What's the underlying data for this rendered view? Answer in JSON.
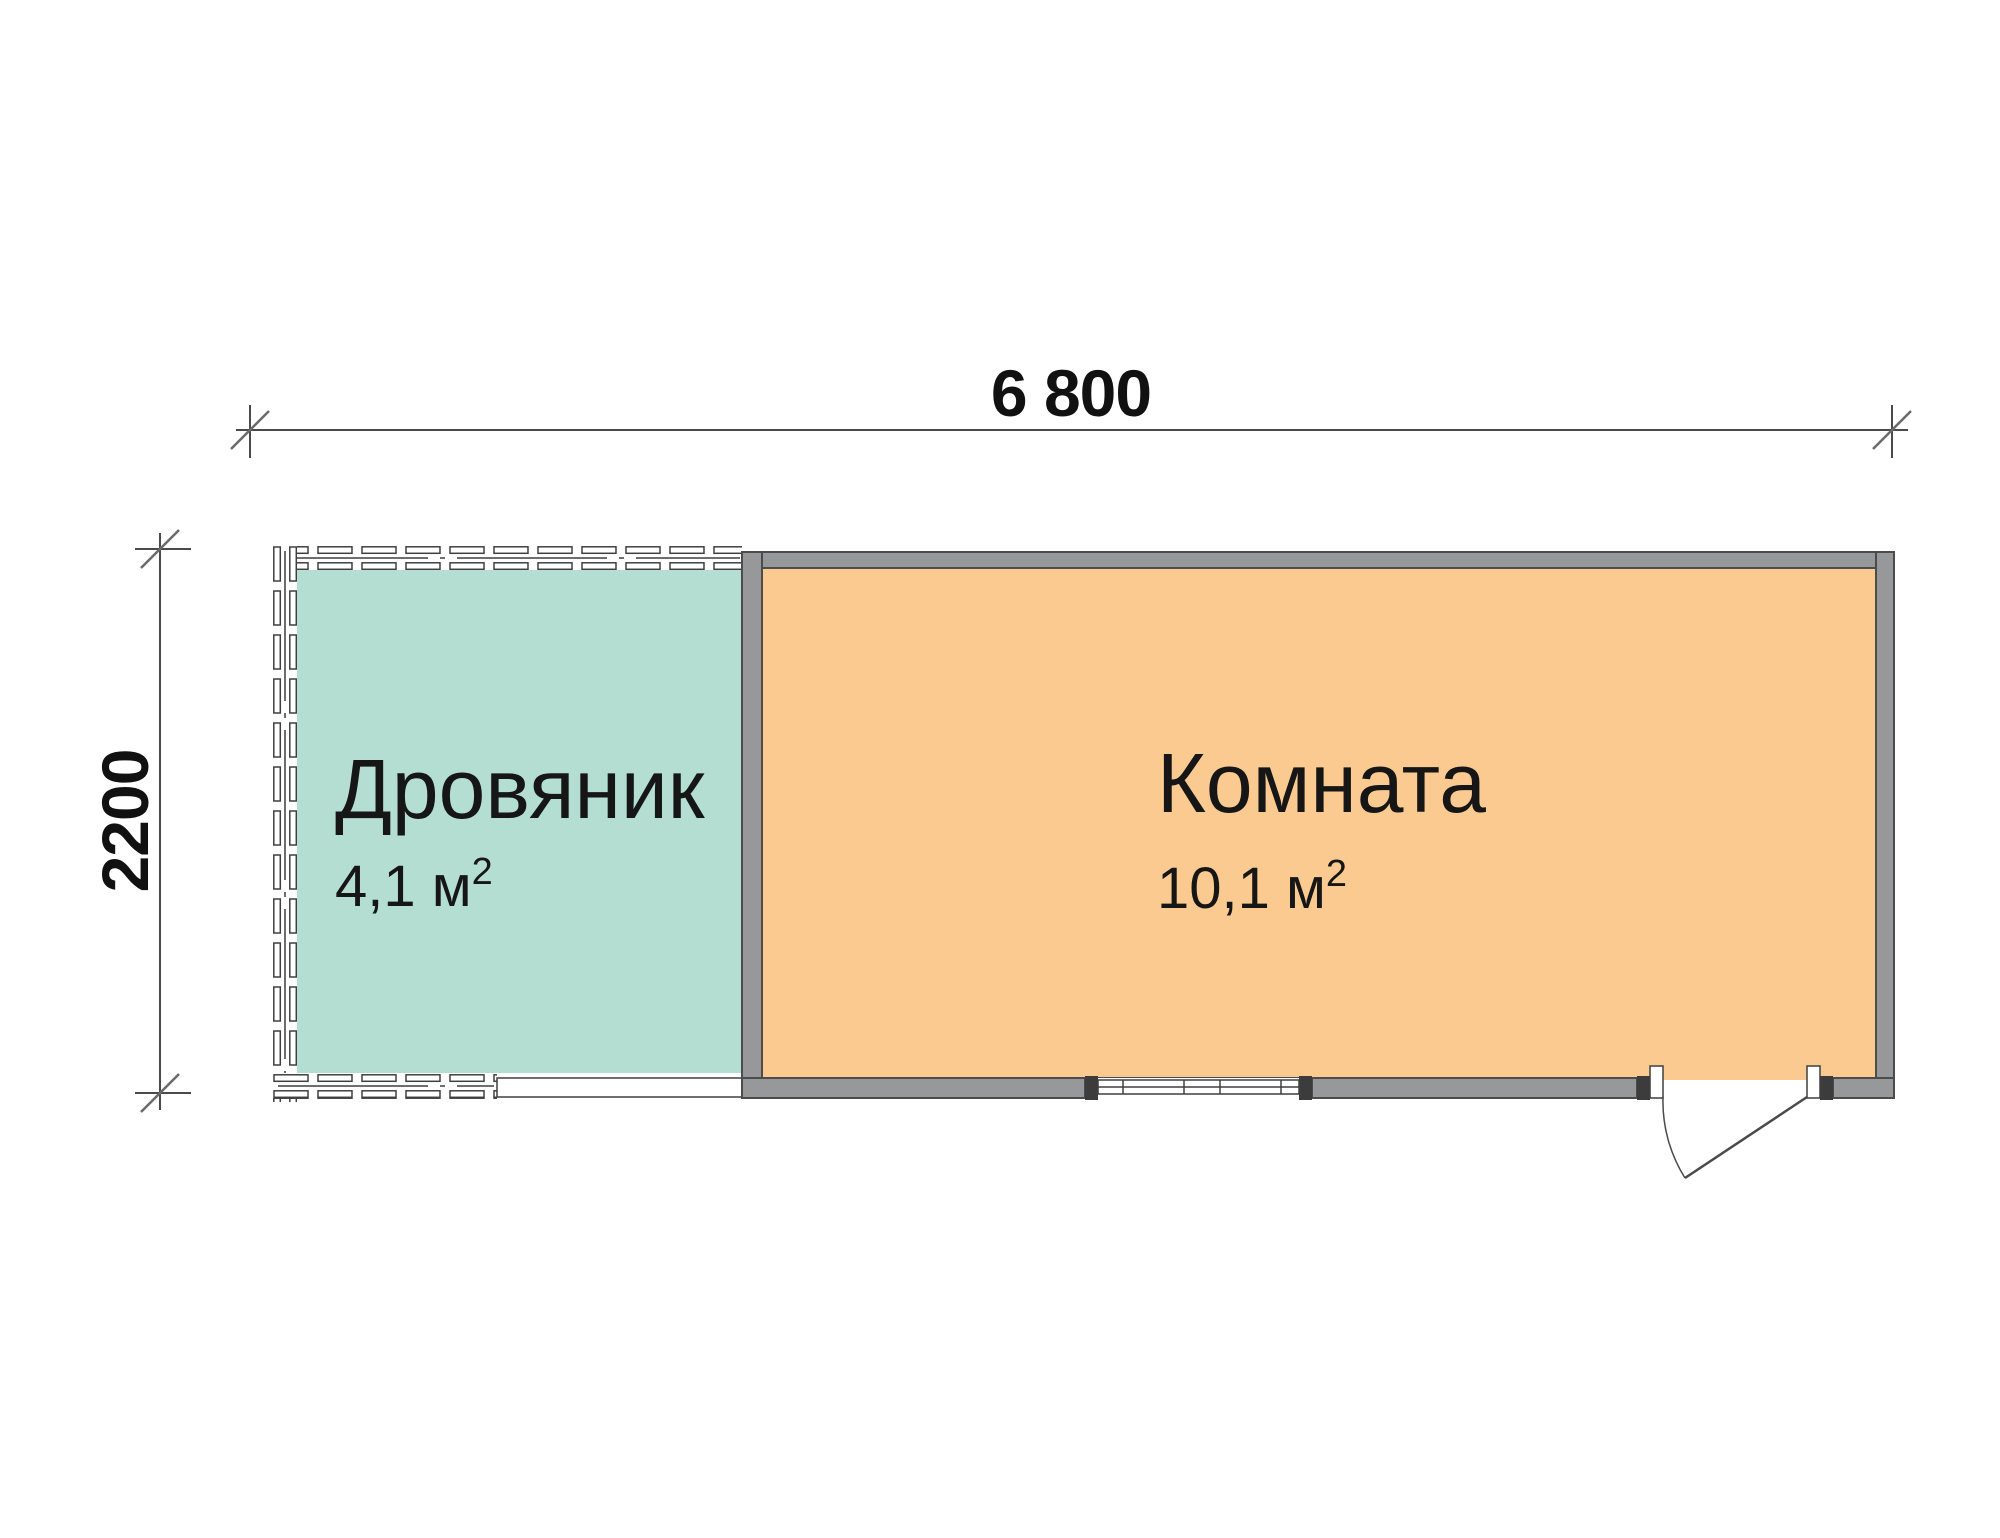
{
  "title": "floor-plan",
  "dimensions": {
    "width": {
      "label": "6 800"
    },
    "height": {
      "label": "2200"
    }
  },
  "rooms": [
    {
      "id": "woodshed",
      "name": "Дровяник",
      "area_value": "4,1 м",
      "area_sup": "2",
      "fill": "#b4ded2"
    },
    {
      "id": "room",
      "name": "Комната",
      "area_value": "10,1 м",
      "area_sup": "2",
      "fill": "#faca90"
    }
  ],
  "colors": {
    "wall_gray": "#969899",
    "wall_outline": "#4c4c4c",
    "wall_cap": "#3c3c3c",
    "line": "#4a4a4a",
    "text": "#161616"
  },
  "features": {
    "window": "window",
    "door": "door"
  }
}
